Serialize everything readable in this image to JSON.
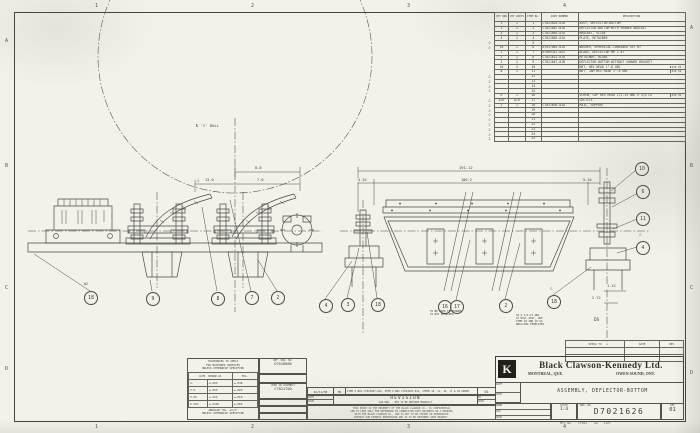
{
  "zones": {
    "top": [
      "1",
      "2",
      "3",
      "4"
    ],
    "bottom": [
      "1",
      "2",
      "3",
      "4"
    ],
    "left": [
      "A",
      "B",
      "C",
      "D"
    ],
    "right": [
      "A",
      "B",
      "C",
      "D"
    ]
  },
  "parts_list": {
    "headers": {
      "qty1": "QTY ORD",
      "qty2": "QTY UNITS",
      "item": "ITEM No.",
      "part": "PART NUMBER",
      "desc": "DESCRIPTION"
    },
    "rows": [
      {
        "delta": "",
        "qty1": "1",
        "qty2": "1",
        "item": "1",
        "part": "C7021626-01A",
        "desc": "ASSY, DEFLECTOR-BOTTOM",
        "mat": ""
      },
      {
        "delta": "",
        "qty1": "1",
        "qty2": "1",
        "item": "2",
        "part": "C7021687-01A",
        "desc": "DEFLECTOR-BOTTOM WITH SHOWER BRACKET",
        "mat": ""
      },
      {
        "delta": "",
        "qty1": "4",
        "qty2": "1",
        "item": "3",
        "part": "C7021685-01A",
        "desc": "BRACKET, SLIDE",
        "mat": ""
      },
      {
        "delta": "",
        "qty1": "4",
        "qty2": "1",
        "item": "4",
        "part": "C7021605-01A",
        "desc": "PLATE, RETAINER",
        "mat": ""
      },
      {
        "delta": "△",
        "qty1": "",
        "qty2": "",
        "item": "5",
        "part": "",
        "desc": "",
        "mat": ""
      },
      {
        "delta": "△",
        "qty1": "16",
        "qty2": "1",
        "item": "6",
        "part": "B7017802-01A",
        "desc": "WASHER, SPHERICAL-COMBINED SET #7",
        "mat": ""
      },
      {
        "delta": "",
        "qty1": "2",
        "qty2": "1",
        "item": "7",
        "part": "B7009341-025",
        "desc": "BLADE, DEFLECTOR MK 2 #7",
        "mat": ""
      },
      {
        "delta": "",
        "qty1": "2",
        "qty2": "1",
        "item": "8",
        "part": "C7021621-01A",
        "desc": "RETAINER, BLADE",
        "mat": ""
      },
      {
        "delta": "",
        "qty1": "1",
        "qty2": "1",
        "item": "9",
        "part": "C7021647-01B",
        "desc": "DEFLECTOR-BOTTOM WITHOUT SHOWER BRACKET",
        "mat": ""
      },
      {
        "delta": "",
        "qty1": "16",
        "qty2": "1",
        "item": "10",
        "part": "",
        "desc": "NUT, HEX HEAD 1\"-8 UNC",
        "mat": "316 SS"
      },
      {
        "delta": "",
        "qty1": "8",
        "qty2": "1",
        "item": "11",
        "part": "",
        "desc": "NUT, JAM HEX HEAD 1\"-8 UNC",
        "mat": "316 SS"
      },
      {
        "delta": "△",
        "qty1": "",
        "qty2": "",
        "item": "12",
        "part": "",
        "desc": "",
        "mat": ""
      },
      {
        "delta": "△",
        "qty1": "",
        "qty2": "",
        "item": "13",
        "part": "",
        "desc": "",
        "mat": ""
      },
      {
        "delta": "△",
        "qty1": "",
        "qty2": "",
        "item": "14",
        "part": "",
        "desc": "",
        "mat": ""
      },
      {
        "delta": "△",
        "qty1": "",
        "qty2": "",
        "item": "15",
        "part": "",
        "desc": "",
        "mat": ""
      },
      {
        "delta": "",
        "qty1": "6",
        "qty2": "1",
        "item": "16",
        "part": "",
        "desc": "SCREW, CAP HEX HEAD 1/2-13 UNC X 3/4 LG",
        "mat": "316 SS"
      },
      {
        "delta": "△",
        "qty1": "A/R",
        "qty2": "A/R",
        "item": "17",
        "part": "",
        "desc": "LOCTITE",
        "mat": ""
      },
      {
        "delta": "△",
        "qty1": "2",
        "qty2": "1",
        "item": "18",
        "part": "C7021636-01A",
        "desc": "RAIL, SUPPORT",
        "mat": ""
      },
      {
        "delta": "△",
        "qty1": "",
        "qty2": "",
        "item": "19",
        "part": "",
        "desc": "",
        "mat": ""
      },
      {
        "delta": "△",
        "qty1": "",
        "qty2": "",
        "item": "20",
        "part": "",
        "desc": "",
        "mat": ""
      },
      {
        "delta": "△",
        "qty1": "",
        "qty2": "",
        "item": "21",
        "part": "",
        "desc": "",
        "mat": ""
      },
      {
        "delta": "△",
        "qty1": "",
        "qty2": "",
        "item": "22",
        "part": "",
        "desc": "",
        "mat": ""
      },
      {
        "delta": "△",
        "qty1": "",
        "qty2": "",
        "item": "23",
        "part": "",
        "desc": "",
        "mat": ""
      },
      {
        "delta": "△",
        "qty1": "",
        "qty2": "",
        "item": "24",
        "part": "",
        "desc": "",
        "mat": ""
      },
      {
        "delta": "△",
        "qty1": "",
        "qty2": "",
        "item": "25",
        "part": "",
        "desc": "",
        "mat": ""
      }
    ]
  },
  "left_view": {
    "centerline_label": "℄ 'C' ROLL",
    "dim_8": "8.0",
    "dim_13": "13.0",
    "dim_7": "7.0",
    "delta": "△",
    "weld_note": "#2",
    "balloons": [
      "18",
      "9",
      "8",
      "7",
      "2"
    ]
  },
  "right_view": {
    "dim_overall": "191.12",
    "dim_left": "5.34",
    "dim_center": "180.2",
    "dim_right": "5.34",
    "dim_112": "1.12",
    "dim_272": "2.72",
    "delta": "△",
    "balloons_bottom": [
      "4",
      "3",
      "18",
      "16",
      "17",
      "2",
      "18"
    ],
    "balloons_right": [
      "10",
      "6",
      "11",
      "4"
    ],
    "note_shower_1": "TO BE USED IF SHOWER",
    "note_shower_2": "IS NOT REQUIRED",
    "note_drill_1": "18 X 1/2-13 UNC",
    "note_drill_2": "AT MILL ASSY, USE",
    "note_drill_3": "ITEM 18 AND 19 AS",
    "note_drill_4": "DRILLING TEMPLATES",
    "label_ds": "DS"
  },
  "tolerance_block": {
    "title_1": "TOLERANCES TO APPLY",
    "title_2": "FOR MACHINED SURFACES",
    "title_3": "UNLESS OTHERWISE SPECIFIED",
    "col_dim": "DIM. SHOWN AS",
    "col_tol": "TOL.",
    "rows": [
      {
        "dim": "X.",
        "mid": "±.XXX",
        "tol": "±.040"
      },
      {
        "dim": "X.X",
        "mid": "±.XXX",
        "tol": "±.020"
      },
      {
        "dim": "X.XX",
        "mid": "±.XXX",
        "tol": "±.010"
      },
      {
        "dim": "X.XXX",
        "mid": "±.XXXX",
        "tol": "±.005"
      }
    ],
    "angular_1": "ANGULAR TOL. ±1/2°",
    "angular_2": "UNLESS OTHERWISE SPECIFIED"
  },
  "ref_block": {
    "ref_label": "REF. DWG. NO.",
    "ref_value": "D7018086",
    "used_label": "USED IN ASSEMBLY",
    "used_value": "C7021700"
  },
  "revision_block": {
    "date": "01/11/98",
    "by": "MO",
    "description": "ITEM 2 WAS C7021687-01A, ITEM 9 WAS C7021647-01A, ITEMS 10, 11, 16, 17 & 18 ADDED, DIM 13.0 WAS 11.0",
    "rev": "01",
    "title": "REVISION",
    "subtitle": "CAD DWG. - NOT TO BE REVISED MANUALLY",
    "date_label": "DATE",
    "apvd_label": "APVD",
    "by_label": "BY",
    "legal_1": "THIS PRINT IS THE PROPERTY OF THE BLACK CLAWSON CO., IS CONFIDENTIAL",
    "legal_2": "AND IS LENT ONLY FOR REFERENCE IN CONNECTION WITH BUSINESS OR A BINDING",
    "legal_3": "WITH THE BLACK CLAWSON CO., AND IS NOT TO BE COPIED OR REPRODUCED",
    "legal_4": "WITHOUT OUR EXPRESS PERMISSION AND IS TO BE RETURNED UPON REQUEST."
  },
  "sepia_table": {
    "col_1": "SEPIA TO",
    "col_2": "DATE",
    "col_3": "REV"
  },
  "title_block": {
    "logo_letter": "K",
    "company": "Black Clawson-Kennedy Ltd.",
    "city_left": "MONTREAL, QUE.",
    "city_right": "OWEN SOUND, ONT.",
    "drawing_title": "ASSEMBLY, DEFLECTOR-BOTTOM",
    "date_label": "DATE",
    "apvd_label": "APVD",
    "drwn_label": "DRWN",
    "ckd_label": "CKD",
    "scale_label": "SCALE",
    "scale_value": "1:4",
    "dwg_no_label": "DWG. NO.",
    "dwg_no": "D7021626",
    "rev_label": "REV",
    "rev_value": "01",
    "mtl_label": "MTL NO.",
    "mtl_value": "C7021",
    "code_a": "AA",
    "code_b": "1127"
  }
}
